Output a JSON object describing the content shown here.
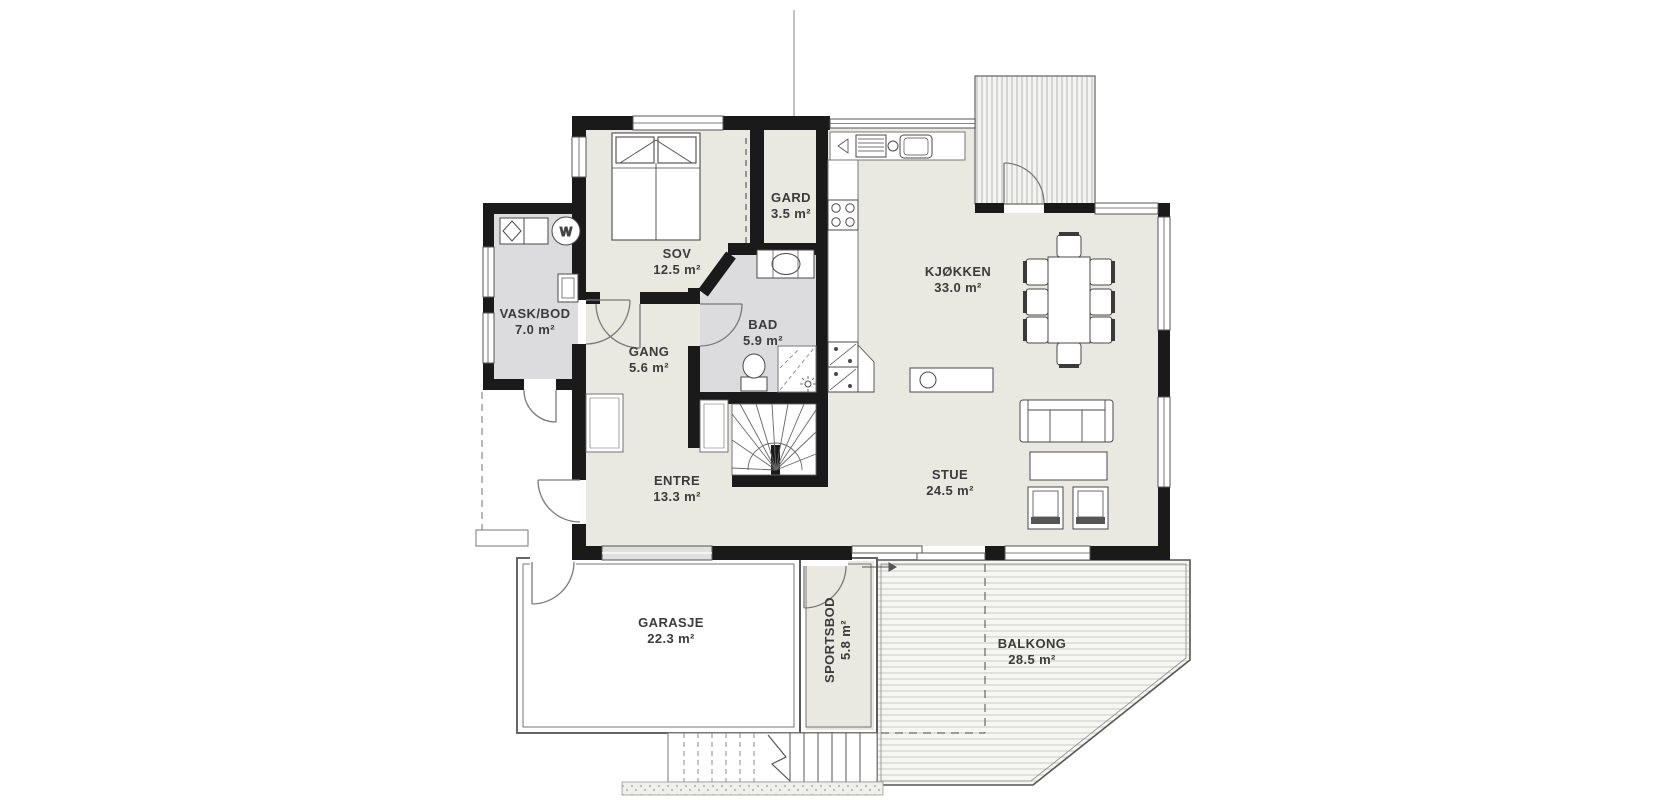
{
  "plan": {
    "title": "Floor plan - first floor",
    "rooms": {
      "sov": {
        "name": "SOV",
        "area": "12.5 m²"
      },
      "gard": {
        "name": "GARD",
        "area": "3.5 m²"
      },
      "vask_bod": {
        "name": "VASK/BOD",
        "area": "7.0 m²"
      },
      "gang": {
        "name": "GANG",
        "area": "5.6 m²"
      },
      "bad": {
        "name": "BAD",
        "area": "5.9 m²"
      },
      "entre": {
        "name": "ENTRE",
        "area": "13.3 m²"
      },
      "kjokken": {
        "name": "KJØKKEN",
        "area": "33.0 m²"
      },
      "stue": {
        "name": "STUE",
        "area": "24.5 m²"
      },
      "garasje": {
        "name": "GARASJE",
        "area": "22.3 m²"
      },
      "sportsbod": {
        "name": "SPORTSBOD",
        "area": "5.8 m²"
      },
      "balkong": {
        "name": "BALKONG",
        "area": "28.5 m²"
      }
    },
    "appliances": {
      "washer_label": "W"
    },
    "colors": {
      "wall": "#1a1a1a",
      "floor": "#e9e8e1",
      "wet_floor": "#dcdcde",
      "deck_line": "#cac9c4",
      "hatch_line": "#b6b6b4",
      "line": "#4a4a4a",
      "label_text": "#3b3b3b"
    }
  }
}
